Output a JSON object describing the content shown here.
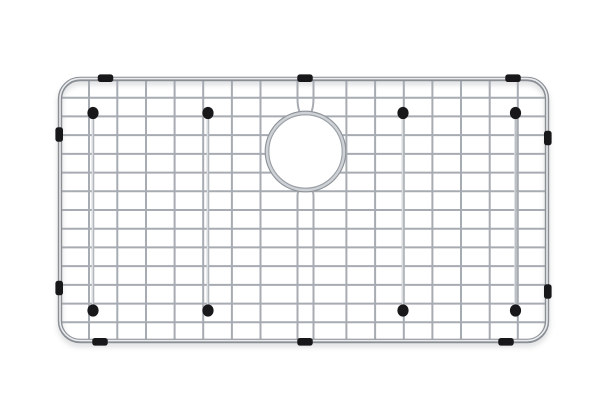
{
  "scene": {
    "description": "Top-down product photo of a stainless steel sink bottom grid with a circular drain opening, wire feet posts with black rubber caps, and black rubber side bumpers, on a plain white background",
    "background_color": "#ffffff",
    "visible_text": "none"
  },
  "palette": {
    "wire": "#a7abb2",
    "wire_light": "#d8dade",
    "frame_dark": "#8a8e95",
    "frame_mid": "#b4b8bd",
    "frame_light": "#e9ebec",
    "ring_base": "#ced2d6",
    "ring_edge_outer": "#8d9298",
    "ring_edge_inner": "#9aa0a6",
    "rubber_black": "#18181b",
    "shadow": "rgba(100,104,110,0.20)"
  },
  "frame": {
    "x": 60,
    "y": 79,
    "width": 487,
    "height": 262,
    "corner_radius": 20,
    "tube_width": 4.4,
    "highlight_width": 1.6
  },
  "grid": {
    "wire_width": 2,
    "vertical_wires": [
      89,
      117.3,
      146,
      174.6,
      203.2,
      231.9,
      260.5,
      346.4,
      375.1,
      403.8,
      432.4,
      461,
      489.7,
      517.8
    ],
    "horizontal_wires": [
      97.7,
      116.4,
      135.1,
      153.9,
      172.6,
      191.3,
      210,
      228.7,
      247.4,
      266.1,
      284.9,
      303.6,
      322.3
    ],
    "vertical_wire_count_total": 16,
    "horizontal_wire_count": 13
  },
  "hairpin": {
    "left_x": 297.5,
    "right_x": 313.5,
    "top_bend_y": 98,
    "bottom_bend_y": 196
  },
  "drain_opening": {
    "cx": 305.5,
    "cy": 151.5,
    "outer_radius": 38.5,
    "ring_stroke": 4.6,
    "inner_white_radius": 36.3
  },
  "feet": {
    "count": 8,
    "post_top_y": 113.5,
    "post_bottom_y": 310,
    "post_width": 2.6,
    "posts": [
      {
        "x": 93
      },
      {
        "x": 208
      },
      {
        "x": 403
      },
      {
        "x": 515.5
      }
    ],
    "cap_rx": 5.6,
    "cap_ry": 6.1
  },
  "bumpers": {
    "count": 10,
    "edge_size": {
      "w": 15.5,
      "h": 7.6,
      "rx": 2.6
    },
    "side_size": {
      "w": 7.6,
      "h": 14.5,
      "rx": 2.6
    },
    "top_centers_x": [
      105.5,
      305,
      513
    ],
    "bottom_centers_x": [
      100,
      305,
      506
    ],
    "left_centers_y": [
      134.5,
      288
    ],
    "right_centers_y": [
      138,
      291.5
    ]
  }
}
